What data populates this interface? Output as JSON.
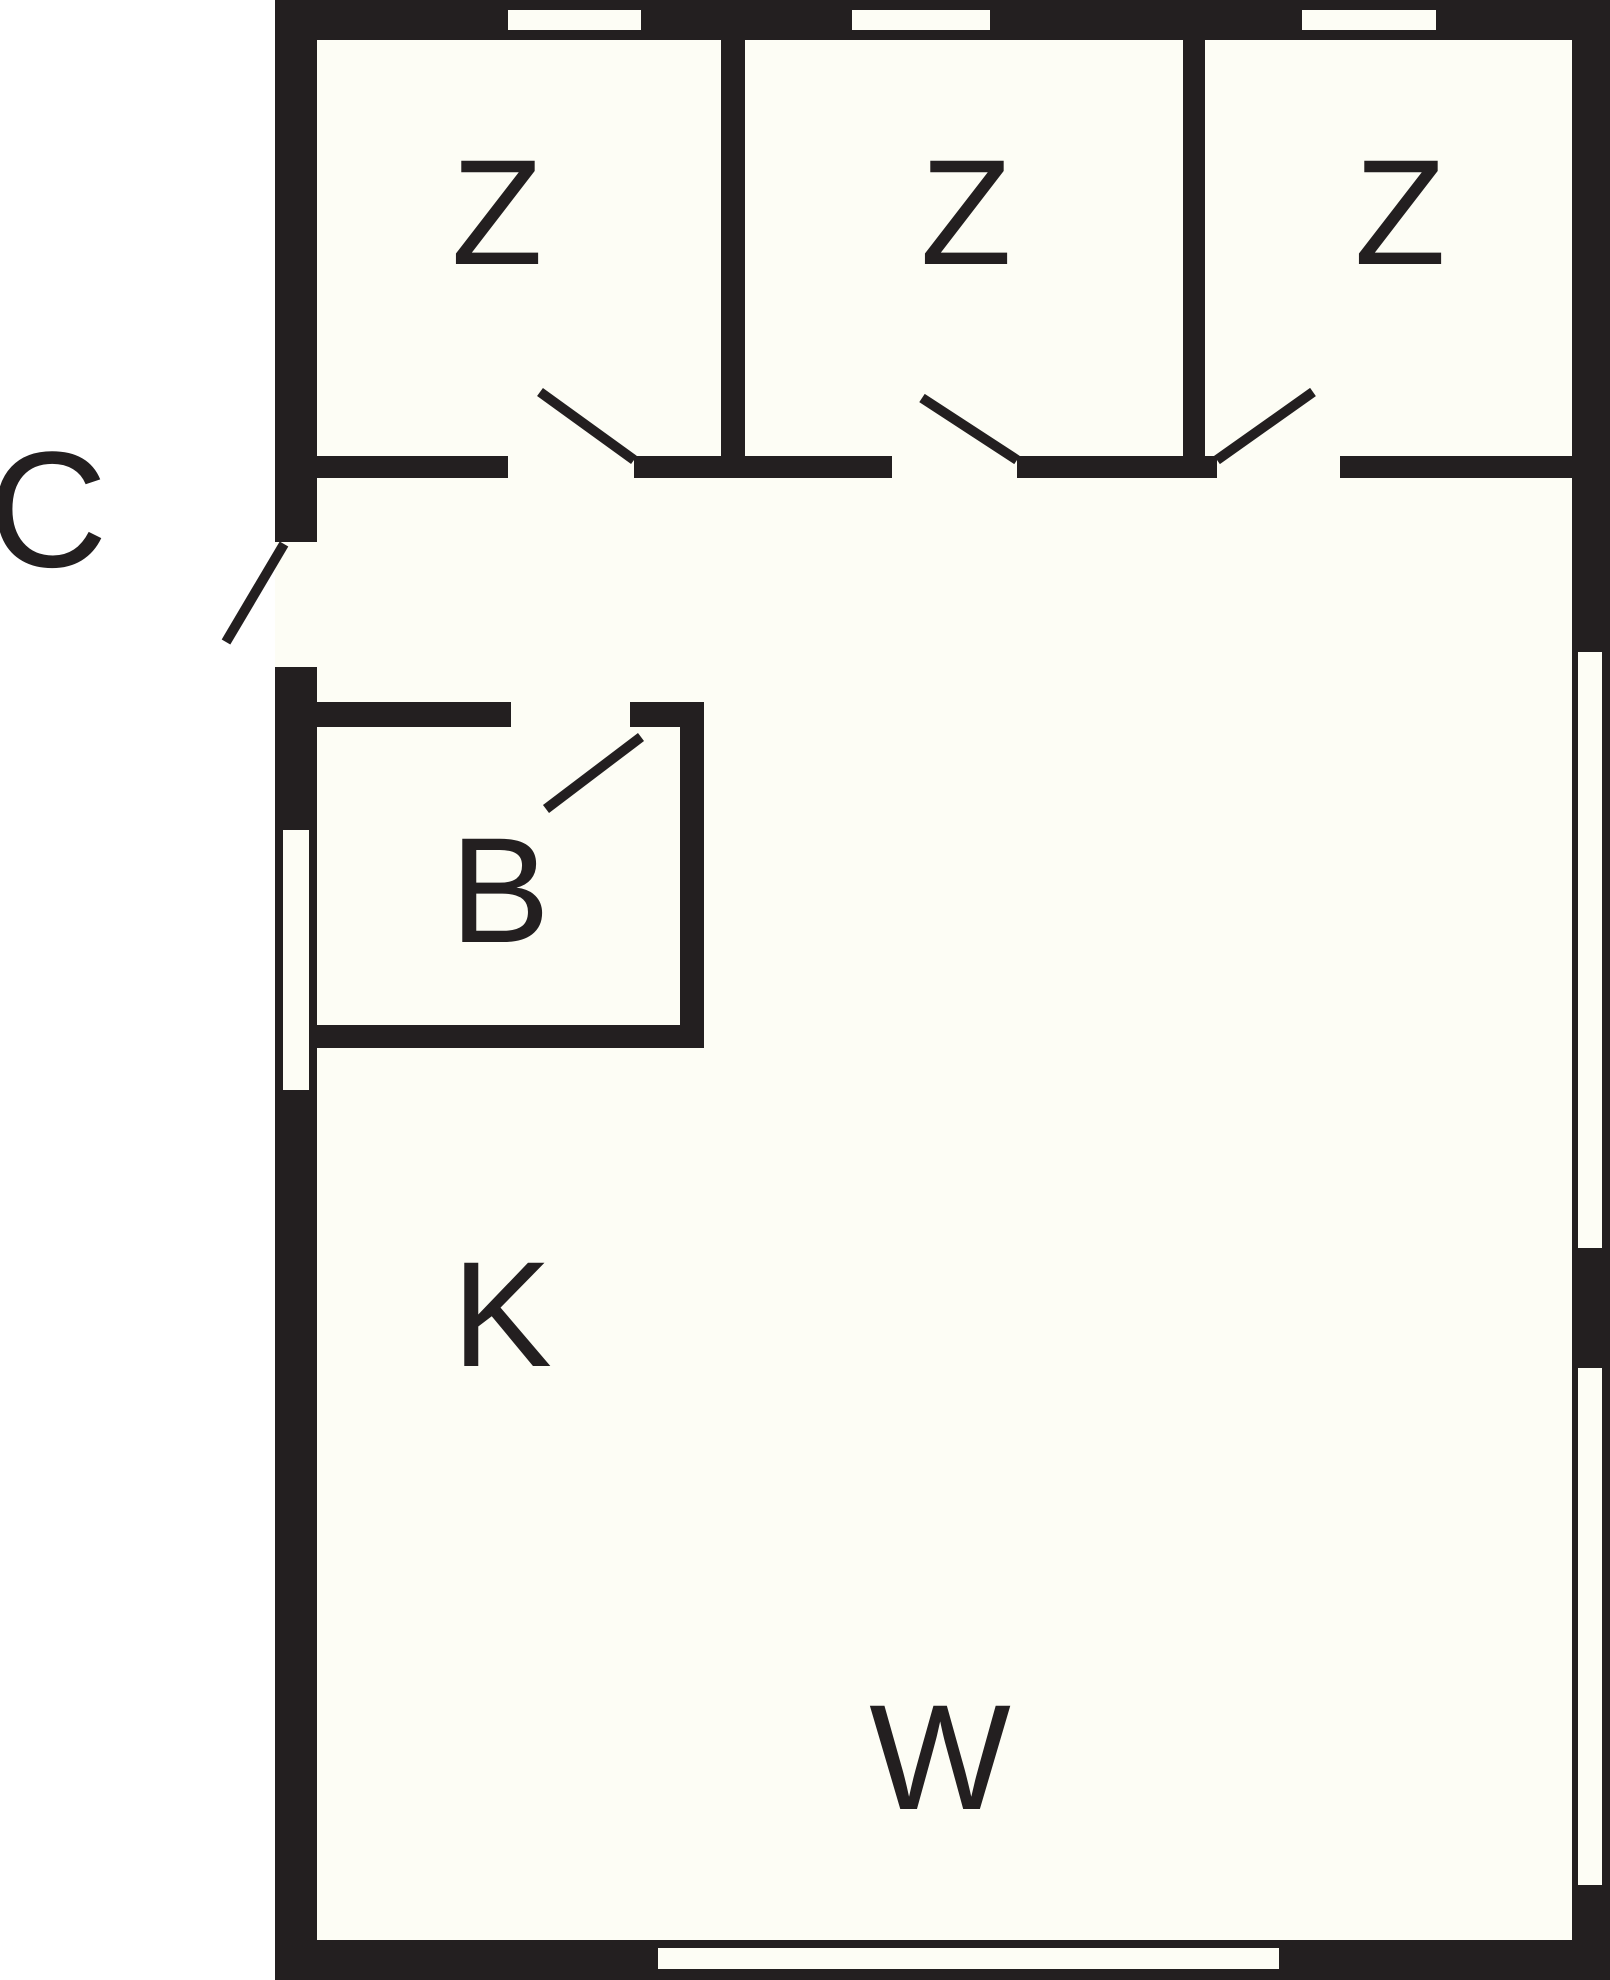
{
  "plan": {
    "type": "floor-plan",
    "outside": {
      "label": "C"
    },
    "rooms": [
      {
        "id": "bedroom-1",
        "label": "Z"
      },
      {
        "id": "bedroom-2",
        "label": "Z"
      },
      {
        "id": "bedroom-3",
        "label": "Z"
      },
      {
        "id": "bathroom",
        "label": "B"
      },
      {
        "id": "kitchen",
        "label": "K"
      },
      {
        "id": "living-room",
        "label": "W"
      }
    ],
    "colors": {
      "wall": "#231f20",
      "floor": "#fdfdf5",
      "outside": "#ffffff",
      "label": "#231f20"
    }
  }
}
